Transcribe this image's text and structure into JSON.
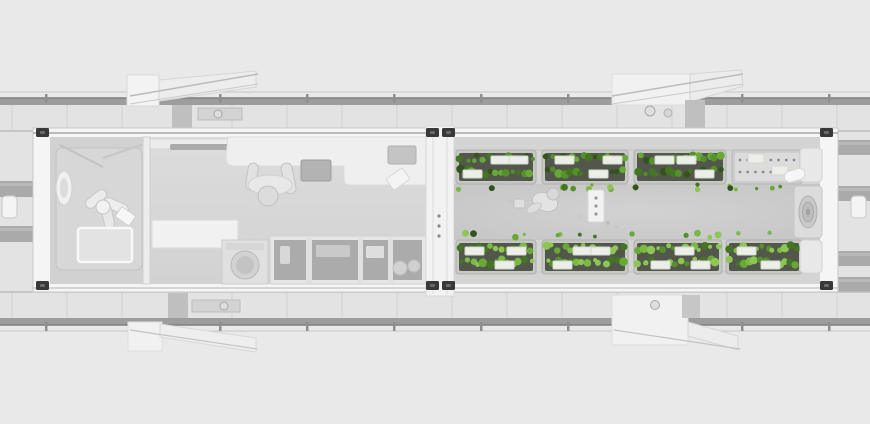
{
  "scene": {
    "name": "container-farm-top-view-render",
    "width": 870,
    "height": 424,
    "palette": {
      "background": "#e9e9e9",
      "deck": "#e3e3e3",
      "deck_seam": "#d2d2d2",
      "deck_shadow": "#bdbdbd",
      "rail_bar": "#9d9d9d",
      "rail_edge": "#7f7f7f",
      "rail_thin": "#c6c6c6",
      "wall": "#f5f5f5",
      "wall_stroke": "#cfcfcf",
      "container_shadow": "#a6a6a6",
      "floor_living": "#d8d8d8",
      "floor_bath": "#d1d1d1",
      "floor_aisle": "#cbcbcb",
      "rack_frame": "#c6c9c3",
      "rack_frame_stroke": "#aeb1ab",
      "rack_bed": "#53564b",
      "tray": "#eceee8",
      "tray_stroke": "#d6d8d2",
      "greens": [
        "#33531c",
        "#447524",
        "#54902c",
        "#67a837",
        "#79b944",
        "#8cc653"
      ],
      "equipment_panel": "#dcdcdc",
      "equipment_dot": "#8c8c8c",
      "corner_fitting": "#383838",
      "figure": "#e4e4e4",
      "figure_stroke": "#c2c2c2",
      "machine": "#e0e0e0",
      "shelf_inner": "#ababab",
      "platform_strip": "#a0a0a0",
      "stair_slab": "#f1f1f1",
      "stair_column": "#bfbfbf"
    },
    "decks": {
      "top_y": 105,
      "bottom_y": 292,
      "height": 26,
      "seam_spacing": 55,
      "seam_offset": 12,
      "rail_top_y": 98,
      "rail_bottom_y": 318,
      "post_spacing": 87,
      "post_offset": 45
    },
    "platforms": {
      "left": {
        "x": 0,
        "w": 33,
        "strips_y": [
          110,
          181,
          226,
          296
        ],
        "strip_h": 16
      },
      "right": {
        "x": 837,
        "w": 33,
        "strips_y": [
          140,
          186,
          251,
          277
        ],
        "strip_h": 15
      }
    },
    "farm": {
      "rack_top_y": 150,
      "rack_bottom_y": 240,
      "rack_h": 34,
      "top_racks": [
        {
          "x": 456,
          "w": 80,
          "trays": [
            [
              44,
              3
            ],
            [
              62,
              3
            ],
            [
              16,
              17
            ]
          ]
        },
        {
          "x": 542,
          "w": 86,
          "trays": [
            [
              22,
              3
            ],
            [
              56,
              17
            ],
            [
              70,
              3
            ]
          ]
        },
        {
          "x": 634,
          "w": 92,
          "trays": [
            [
              30,
              3
            ],
            [
              52,
              3
            ],
            [
              70,
              17
            ]
          ]
        }
      ],
      "bottom_racks": [
        {
          "x": 456,
          "w": 80,
          "trays": [
            [
              18,
              4
            ],
            [
              48,
              18
            ],
            [
              60,
              4
            ]
          ]
        },
        {
          "x": 542,
          "w": 86,
          "trays": [
            [
              40,
              4
            ],
            [
              58,
              4
            ],
            [
              20,
              18
            ]
          ]
        },
        {
          "x": 634,
          "w": 88,
          "trays": [
            [
              26,
              18
            ],
            [
              50,
              4
            ],
            [
              66,
              18
            ]
          ]
        },
        {
          "x": 726,
          "w": 76,
          "trays": [
            [
              20,
              4
            ],
            [
              44,
              18
            ]
          ]
        }
      ],
      "equipment_rack": {
        "x": 732,
        "y": 150,
        "w": 70,
        "h": 34,
        "dot_rows": [
          10,
          22
        ],
        "dot_cols": 8,
        "trays": [
          [
            24,
            4
          ],
          [
            48,
            16
          ]
        ]
      },
      "scatter_rows": [
        {
          "y": 187,
          "count": 18,
          "x0": 458,
          "x1": 800
        },
        {
          "y": 235,
          "count": 15,
          "x0": 458,
          "x1": 795
        }
      ]
    },
    "objects": [
      "left-living-module",
      "right-farm-module",
      "bathroom",
      "wall-oval-sink",
      "ceiling-fan",
      "shower-tray",
      "kitchen-counter",
      "counter-sink",
      "person-at-desk",
      "side-table",
      "washing-machine",
      "storage-shelf",
      "module-junction",
      "plant-racks",
      "seedling-equipment-rack",
      "farmer-figure",
      "supply-cart",
      "exhaust-fan",
      "entry-stairs-top-left",
      "entry-stairs-top-right",
      "entry-stairs-bottom-left",
      "entry-stairs-bottom-right",
      "side-platform-left",
      "side-platform-right",
      "deck-walkway-top",
      "deck-walkway-bottom"
    ]
  }
}
